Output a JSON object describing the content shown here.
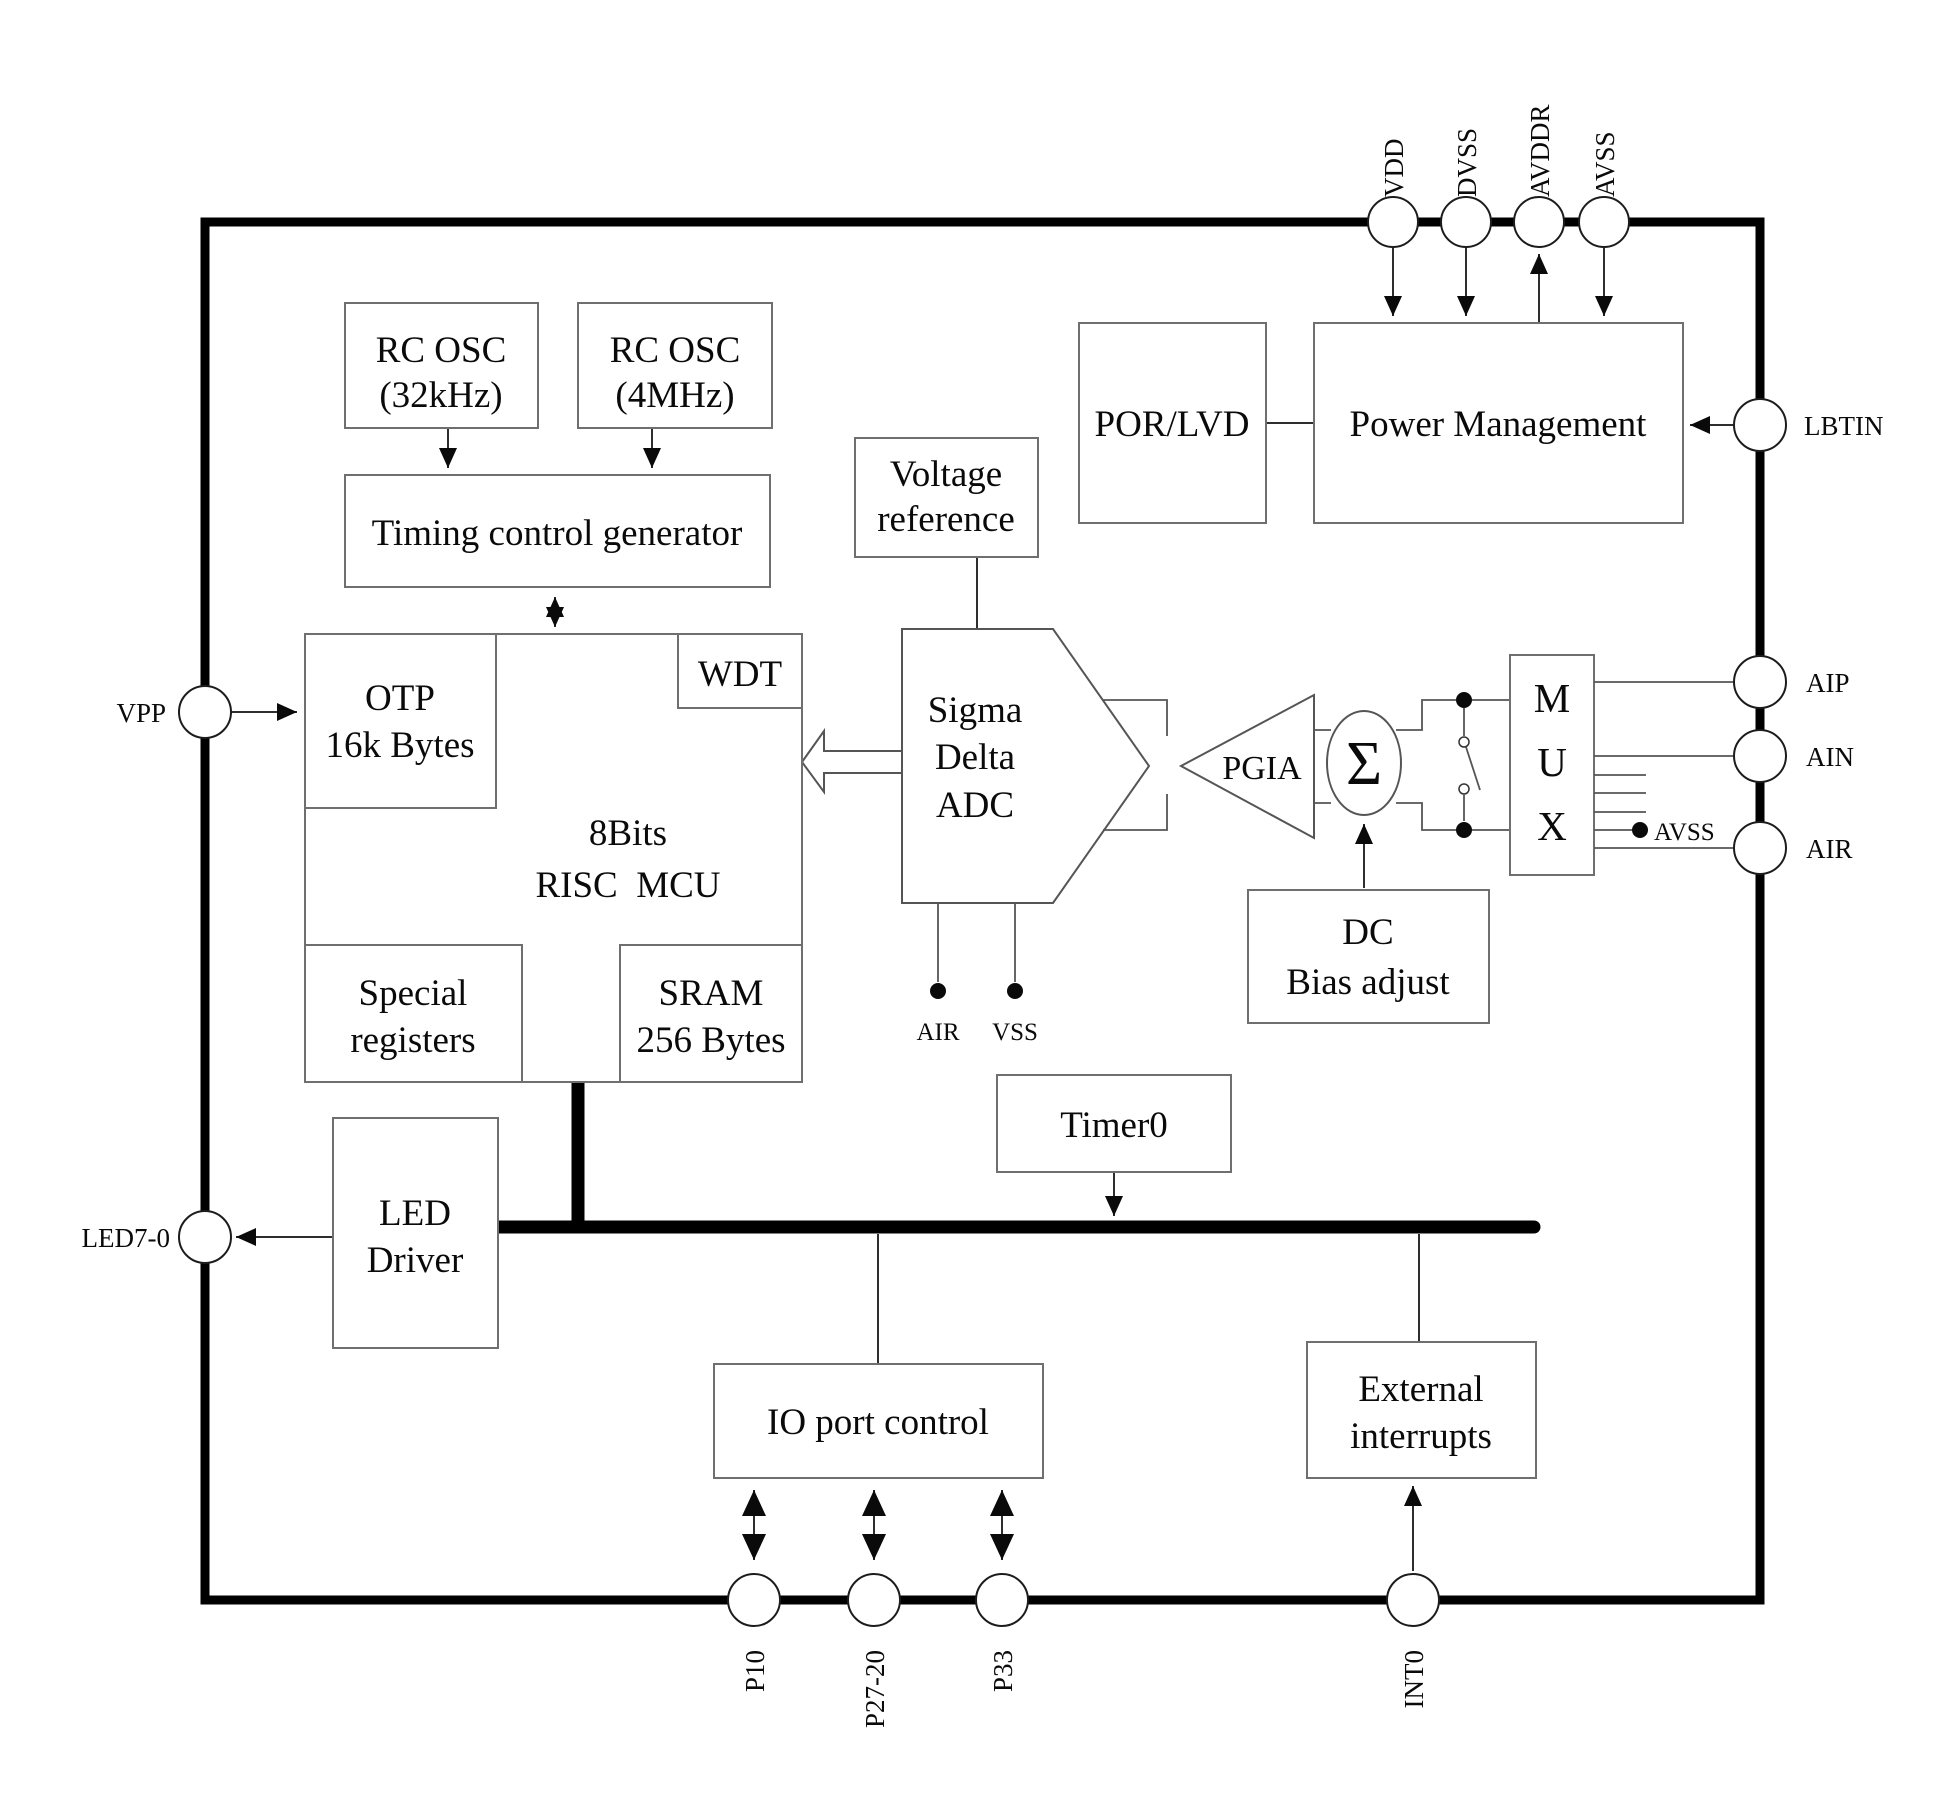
{
  "blocks": {
    "rc_osc_32k": {
      "l1": "RC OSC",
      "l2": "(32kHz)"
    },
    "rc_osc_4m": {
      "l1": "RC OSC",
      "l2": "(4MHz)"
    },
    "timing": {
      "l1": "Timing control generator"
    },
    "por_lvd": {
      "l1": "POR/LVD"
    },
    "power_mgmt": {
      "l1": "Power Management"
    },
    "voltage_ref": {
      "l1": "Voltage",
      "l2": "reference"
    },
    "otp": {
      "l1": "OTP",
      "l2": "16k Bytes"
    },
    "wdt": {
      "l1": "WDT"
    },
    "mcu": {
      "l1": "8Bits",
      "l2": "RISC  MCU"
    },
    "special_regs": {
      "l1": "Special",
      "l2": "registers"
    },
    "sram": {
      "l1": "SRAM",
      "l2": "256 Bytes"
    },
    "adc": {
      "l1": "Sigma",
      "l2": "Delta",
      "l3": "ADC"
    },
    "pgia": {
      "l1": "PGIA"
    },
    "sigma_node": {
      "l1": "Σ"
    },
    "mux": {
      "l1": "M",
      "l2": "U",
      "l3": "X"
    },
    "dc_bias": {
      "l1": "DC",
      "l2": "Bias adjust"
    },
    "led_driver": {
      "l1": "LED",
      "l2": "Driver"
    },
    "timer0": {
      "l1": "Timer0"
    },
    "io_port": {
      "l1": "IO port control"
    },
    "ext_int": {
      "l1": "External",
      "l2": "interrupts"
    }
  },
  "pins": {
    "vdd": "VDD",
    "dvss": "DVSS",
    "avddr": "AVDDR",
    "avss": "AVSS",
    "lbtin": "LBTIN",
    "aip": "AIP",
    "ain": "AIN",
    "air": "AIR",
    "vpp": "VPP",
    "led7_0": "LED7-0",
    "p10": "P10",
    "p27_20": "P27-20",
    "p33": "P33",
    "int0": "INT0"
  },
  "net_labels": {
    "adc_air": "AIR",
    "adc_vss": "VSS",
    "mux_avss": "AVSS"
  },
  "colors": {
    "background": "#ffffff",
    "border": "#000000",
    "box_border": "#6f6f6f",
    "wire": "#2e2e2e",
    "text": "#0a0a0a"
  }
}
